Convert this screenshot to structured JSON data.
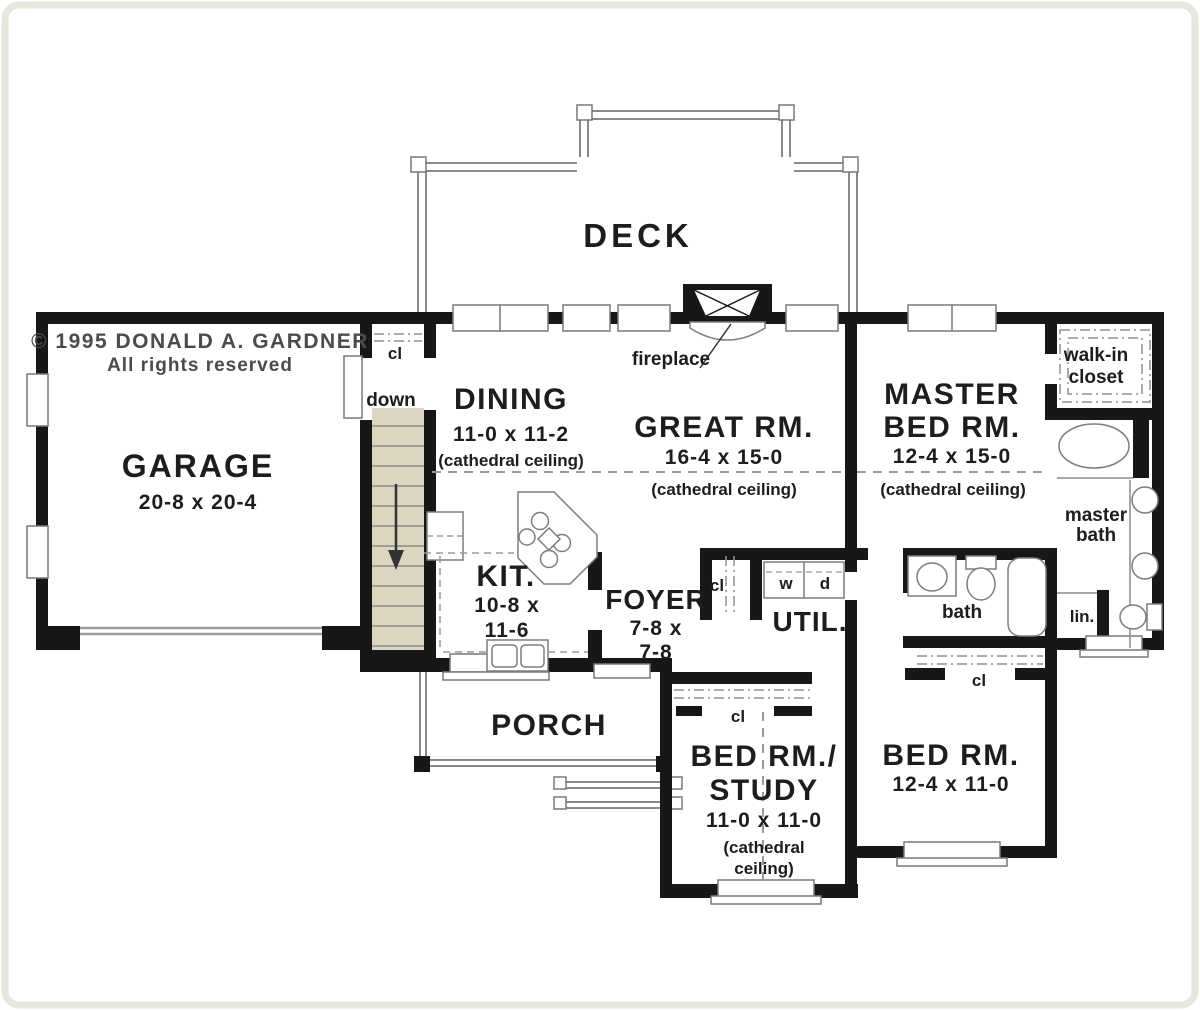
{
  "copyright": {
    "line1": "© 1995 DONALD A. GARDNER",
    "line2": "All rights reserved"
  },
  "rooms": {
    "deck": {
      "name": "DECK"
    },
    "garage": {
      "name": "GARAGE",
      "dims": "20-8 x 20-4"
    },
    "dining": {
      "name": "DINING",
      "dims": "11-0 x 11-2",
      "ceiling": "(cathedral ceiling)"
    },
    "great_room": {
      "name": "GREAT RM.",
      "dims": "16-4 x 15-0",
      "ceiling": "(cathedral ceiling)"
    },
    "master_bedroom": {
      "line1": "MASTER",
      "line2": "BED RM.",
      "dims": "12-4 x 15-0",
      "ceiling": "(cathedral ceiling)"
    },
    "kitchen": {
      "name": "KIT.",
      "dims_line1": "10-8 x",
      "dims_line2": "11-6"
    },
    "foyer": {
      "name": "FOYER",
      "dims_line1": "7-8 x",
      "dims_line2": "7-8"
    },
    "utility": {
      "name": "UTIL."
    },
    "porch": {
      "name": "PORCH"
    },
    "bedroom_study": {
      "line1": "BED RM./",
      "line2": "STUDY",
      "dims": "11-0 x 11-0",
      "ceiling_line1": "(cathedral",
      "ceiling_line2": "ceiling)"
    },
    "bedroom2": {
      "name": "BED RM.",
      "dims": "12-4 x 11-0"
    },
    "walk_in_closet": {
      "line1": "walk-in",
      "line2": "closet"
    },
    "master_bath": {
      "line1": "master",
      "line2": "bath"
    },
    "bath": {
      "name": "bath"
    },
    "linen": {
      "name": "lin."
    }
  },
  "labels": {
    "fireplace": "fireplace",
    "down": "down",
    "washer": "w",
    "dryer": "d",
    "closet": "cl"
  },
  "colors": {
    "wall": "#171717",
    "stair_fill": "#dcd6c1",
    "fixture_line": "#7d7d7d",
    "dash_line": "#9a9a9a",
    "text": "#1d1d1d",
    "copyright_text": "#4b4b4b",
    "frame": "#e8e5da",
    "background": "#ffffff"
  }
}
